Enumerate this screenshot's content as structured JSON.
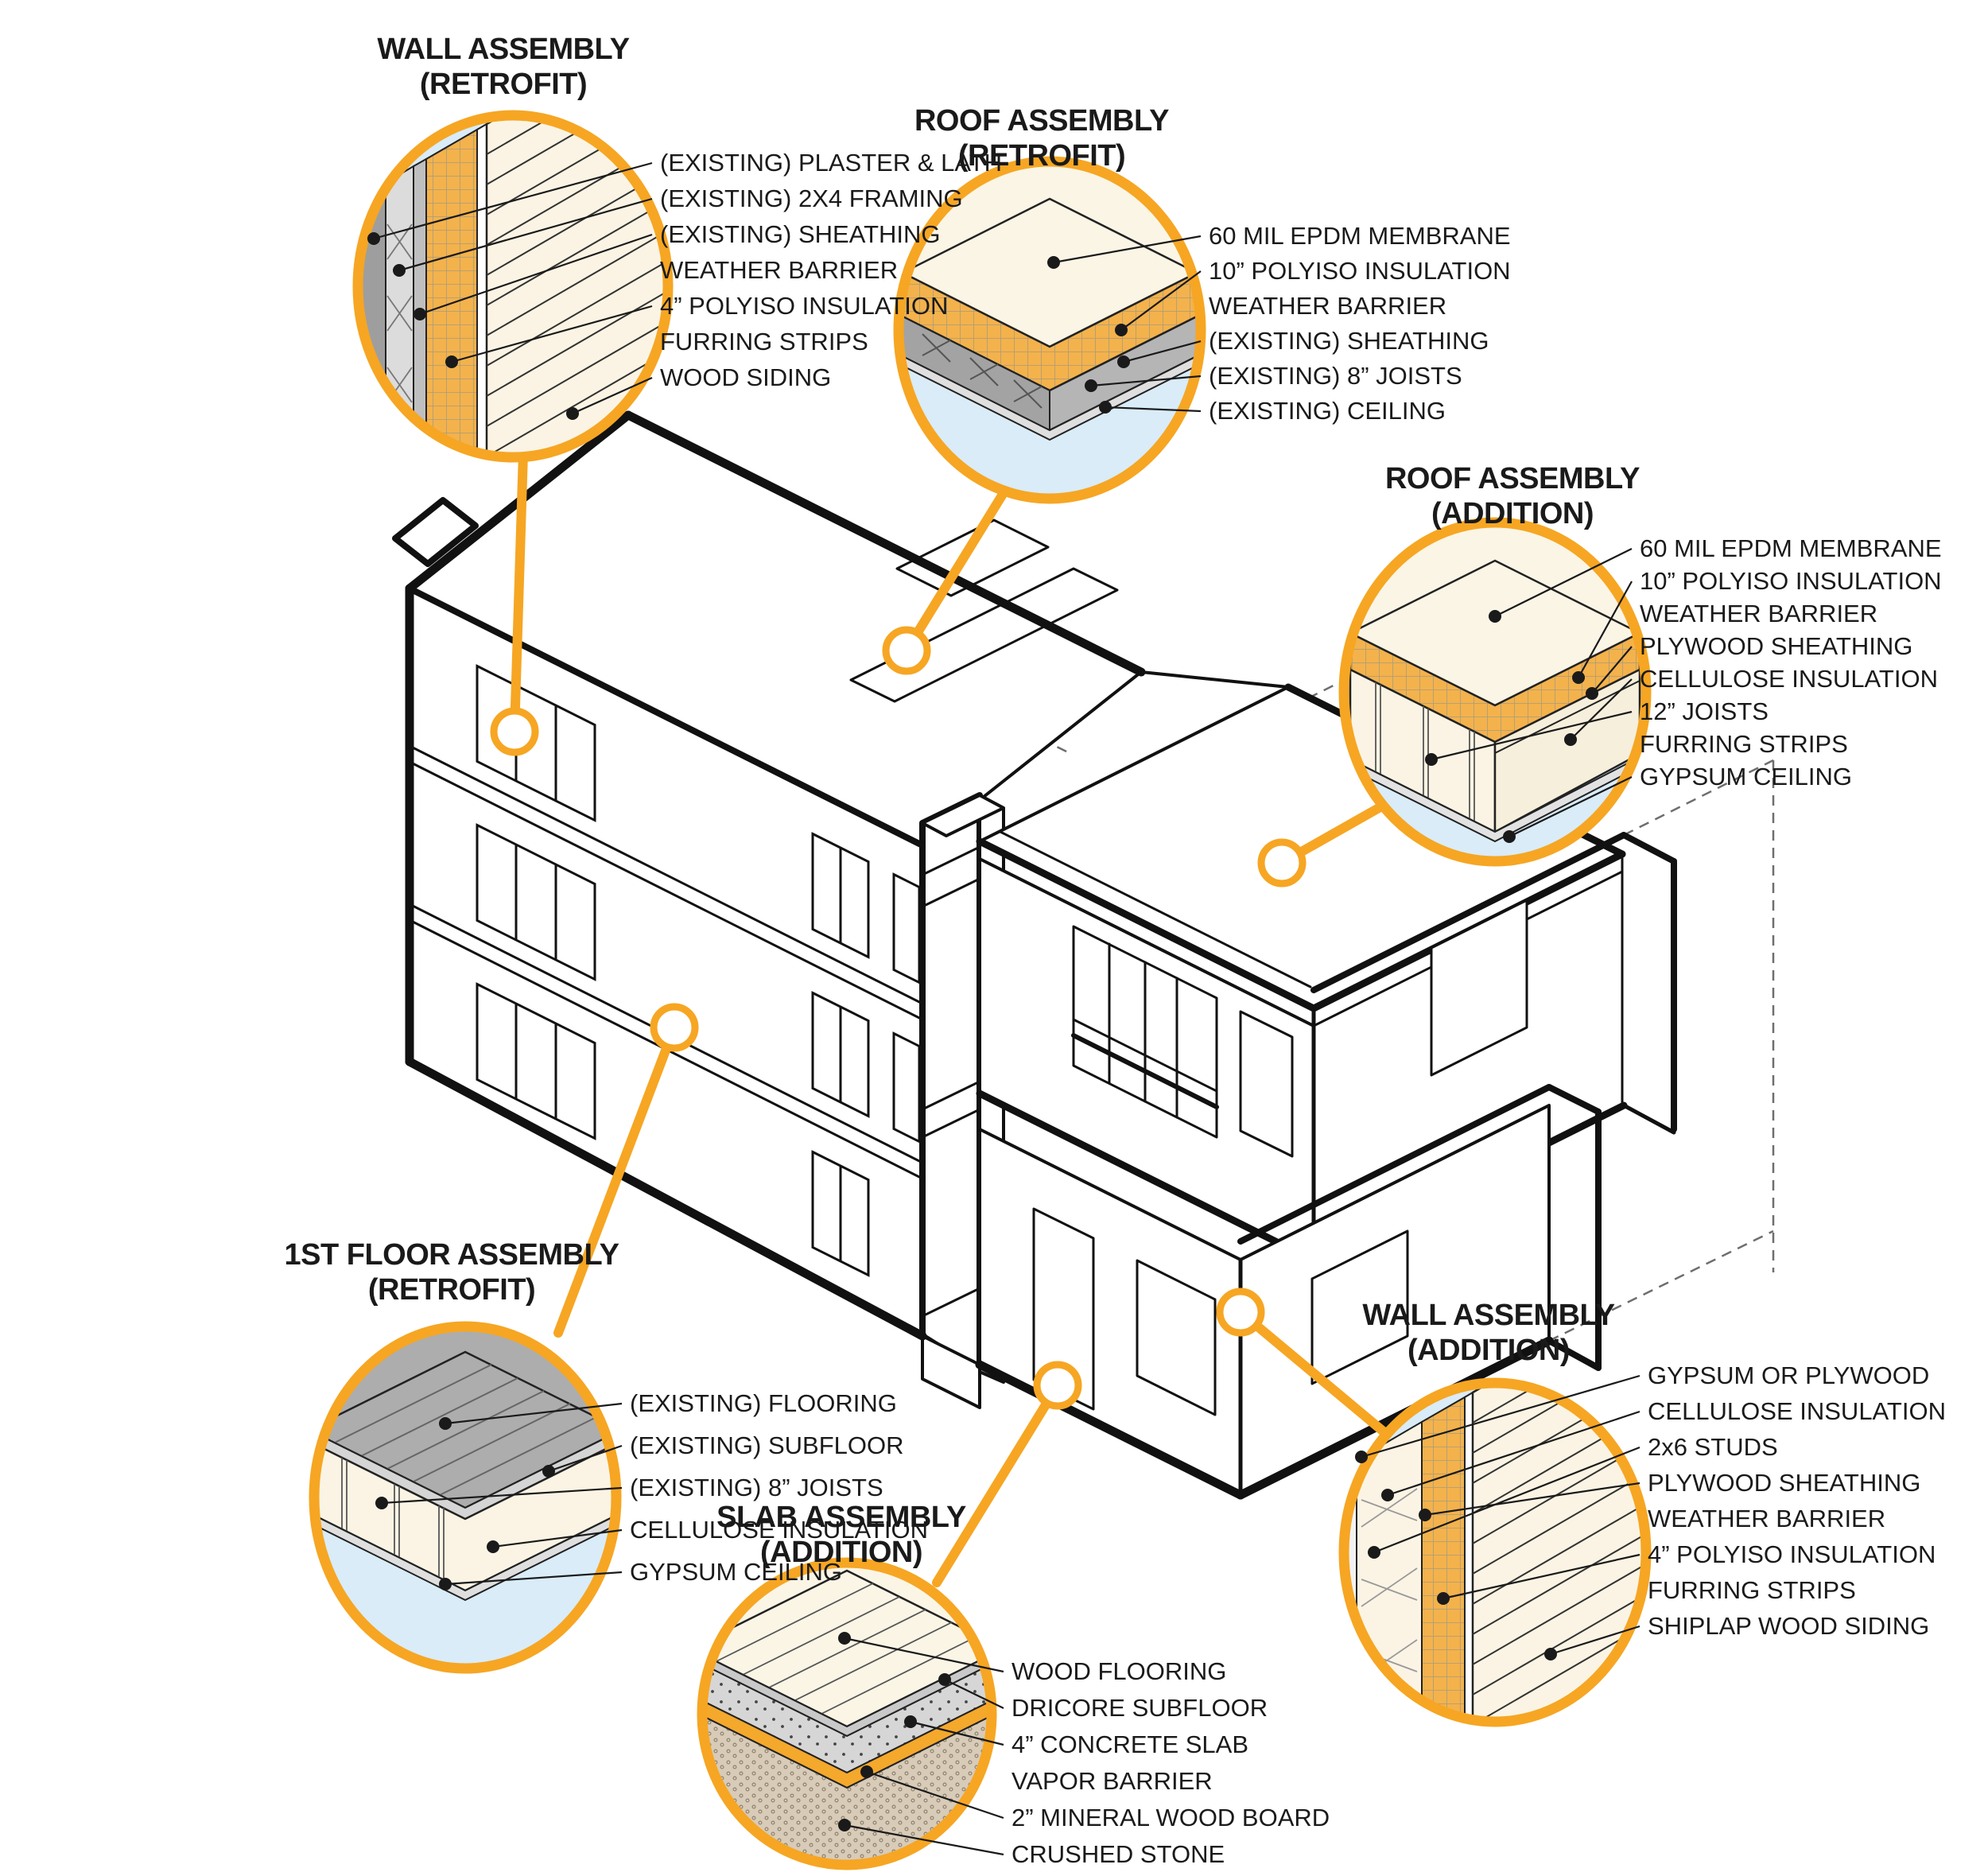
{
  "diagram_title": "Building retrofit and addition assembly diagram",
  "colors": {
    "accent_orange": "#F6A623",
    "circle_fill_blue": "#D9ECF8",
    "insulation_orange": "#F3B24C",
    "cream": "#FBF4E4",
    "membrane_cream": "#FBF5E6",
    "gray_panel": "#B5B5B5",
    "concrete_gray": "#D6D6D6",
    "stone_tan": "#D8CBB8",
    "line_black": "#111111"
  },
  "callouts": [
    {
      "id": "wall-retrofit",
      "title_line1": "WALL ASSEMBLY",
      "title_line2": "(RETROFIT)",
      "labels": [
        {
          "text": "(EXISTING) PLASTER & LATH",
          "leader": true
        },
        {
          "text": "(EXISTING) 2X4 FRAMING",
          "leader": true
        },
        {
          "text": "(EXISTING) SHEATHING",
          "leader": true
        },
        {
          "text": "WEATHER BARRIER",
          "leader": false
        },
        {
          "text": "4” POLYISO INSULATION",
          "leader": true
        },
        {
          "text": "FURRING STRIPS",
          "leader": false
        },
        {
          "text": "WOOD SIDING",
          "leader": true
        }
      ]
    },
    {
      "id": "roof-retrofit",
      "title_line1": "ROOF ASSEMBLY",
      "title_line2": "(RETROFIT)",
      "labels": [
        {
          "text": "60 MIL EPDM MEMBRANE",
          "leader": true
        },
        {
          "text": "10” POLYISO INSULATION",
          "leader": true
        },
        {
          "text": "WEATHER BARRIER",
          "leader": false
        },
        {
          "text": "(EXISTING) SHEATHING",
          "leader": true
        },
        {
          "text": "(EXISTING) 8” JOISTS",
          "leader": true
        },
        {
          "text": "(EXISTING) CEILING",
          "leader": true
        }
      ]
    },
    {
      "id": "roof-addition",
      "title_line1": "ROOF ASSEMBLY",
      "title_line2": "(ADDITION)",
      "labels": [
        {
          "text": "60 MIL EPDM MEMBRANE",
          "leader": true
        },
        {
          "text": "10” POLYISO INSULATION",
          "leader": true
        },
        {
          "text": "WEATHER BARRIER",
          "leader": false
        },
        {
          "text": "PLYWOOD SHEATHING",
          "leader": true
        },
        {
          "text": "CELLULOSE INSULATION",
          "leader": true
        },
        {
          "text": "12” JOISTS",
          "leader": true
        },
        {
          "text": "FURRING STRIPS",
          "leader": false
        },
        {
          "text": "GYPSUM CEILING",
          "leader": true
        }
      ]
    },
    {
      "id": "first-floor-retrofit",
      "title_line1": "1ST FLOOR ASSEMBLY",
      "title_line2": "(RETROFIT)",
      "labels": [
        {
          "text": "(EXISTING) FLOORING",
          "leader": true
        },
        {
          "text": "(EXISTING) SUBFLOOR",
          "leader": true
        },
        {
          "text": "(EXISTING) 8” JOISTS",
          "leader": true
        },
        {
          "text": "CELLULOSE INSULATION",
          "leader": true
        },
        {
          "text": "GYPSUM CEILING",
          "leader": true
        }
      ]
    },
    {
      "id": "slab-addition",
      "title_line1": "SLAB ASSEMBLY",
      "title_line2": "(ADDITION)",
      "labels": [
        {
          "text": "WOOD FLOORING",
          "leader": true
        },
        {
          "text": "DRICORE SUBFLOOR",
          "leader": true
        },
        {
          "text": "4” CONCRETE SLAB",
          "leader": true
        },
        {
          "text": "VAPOR BARRIER",
          "leader": false
        },
        {
          "text": "2” MINERAL WOOD BOARD",
          "leader": true
        },
        {
          "text": "CRUSHED STONE",
          "leader": true
        }
      ]
    },
    {
      "id": "wall-addition",
      "title_line1": "WALL ASSEMBLY",
      "title_line2": "(ADDITION)",
      "labels": [
        {
          "text": "GYPSUM OR PLYWOOD",
          "leader": true
        },
        {
          "text": "CELLULOSE INSULATION",
          "leader": true
        },
        {
          "text": "2x6 STUDS",
          "leader": true
        },
        {
          "text": "PLYWOOD SHEATHING",
          "leader": true
        },
        {
          "text": "WEATHER BARRIER",
          "leader": false
        },
        {
          "text": "4” POLYISO INSULATION",
          "leader": true
        },
        {
          "text": "FURRING STRIPS",
          "leader": false
        },
        {
          "text": "SHIPLAP WOOD SIDING",
          "leader": true
        }
      ]
    }
  ]
}
